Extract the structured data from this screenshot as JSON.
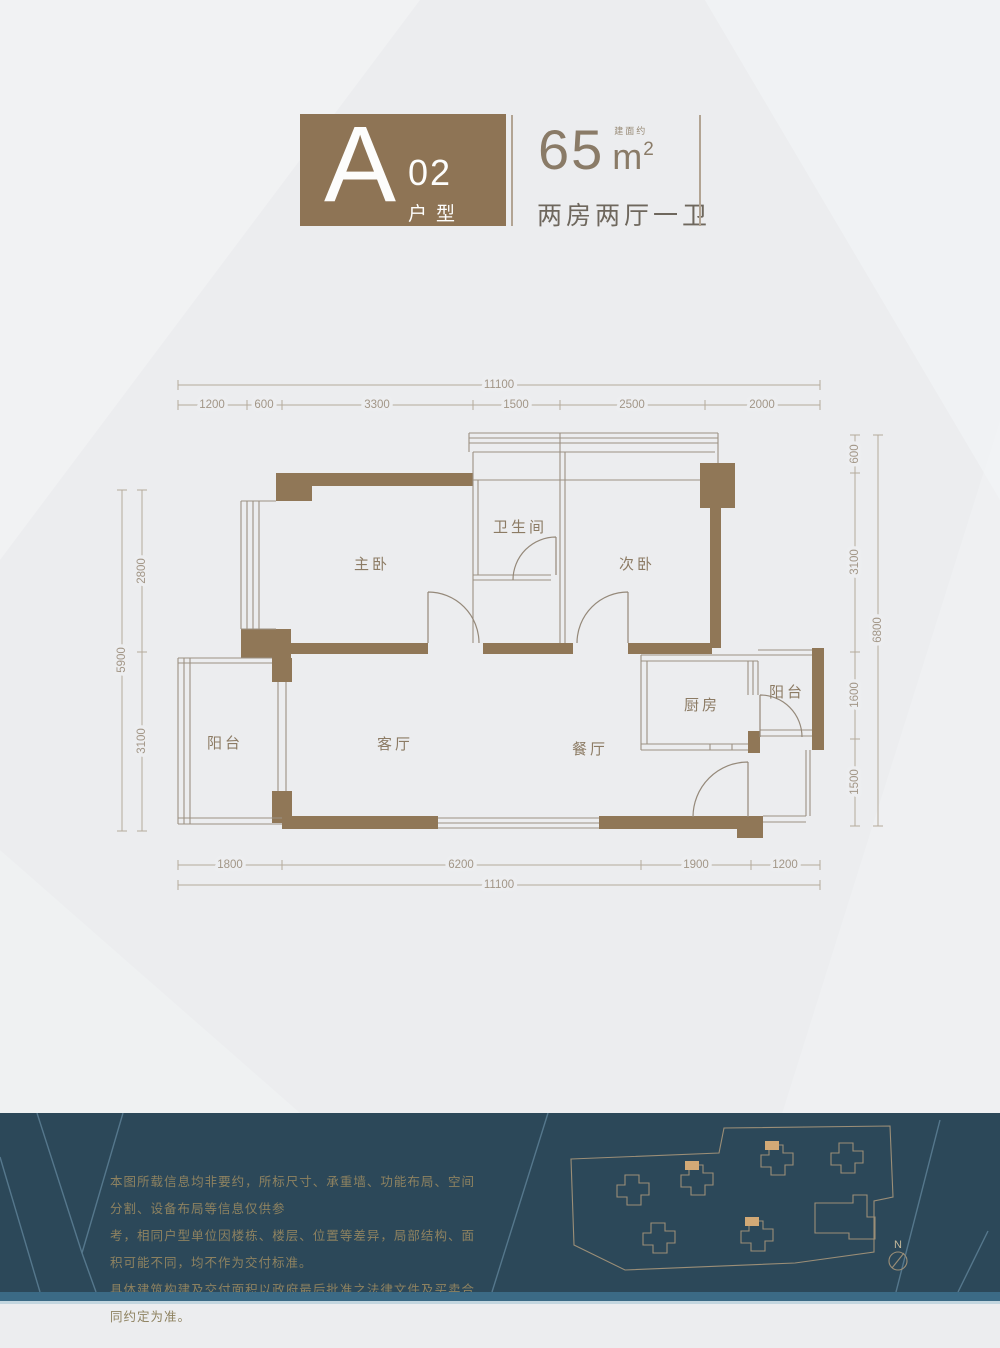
{
  "header": {
    "unit_letter": "A",
    "unit_code": "02",
    "unit_type_label": "户型",
    "area_number": "65",
    "area_prefix": "建面约",
    "area_unit": "m",
    "area_power": "2",
    "layout": "两房两厅一卫"
  },
  "plan": {
    "rooms": {
      "master": "主卧",
      "bath": "卫生间",
      "second": "次卧",
      "balcony_left": "阳台",
      "living": "客厅",
      "dining": "餐厅",
      "kitchen": "厨房",
      "balcony_right": "阳台"
    },
    "dims": {
      "top_total": "11100",
      "top": [
        "1200",
        "600",
        "3300",
        "1500",
        "2500",
        "2000"
      ],
      "left_total": "5900",
      "left": [
        "2800",
        "3100"
      ],
      "right": [
        "600",
        "3100",
        "1600",
        "1500"
      ],
      "right_total": "6800",
      "bottom": [
        "1800",
        "6200",
        "1900",
        "1200"
      ],
      "bottom_total": "11100"
    }
  },
  "footer": {
    "disclaimer": [
      "本图所载信息均非要约，所标尺寸、承重墙、功能布局、空间分割、设备布局等信息仅供参",
      "考，相同户型单位因楼栋、楼层、位置等差异，局部结构、面积可能不同，均不作为交付标准。",
      "具体建筑构建及交付面积以政府最后批准之法律文件及买卖合同约定为准。"
    ],
    "north_label": "N"
  },
  "colors": {
    "wall_brown": "#907757",
    "header_brown": "#8e7455",
    "footer_teal": "#2c4859",
    "footer_strip": "#3b6a85",
    "highlight_tan": "#d2a976",
    "background": "#ecedef"
  }
}
